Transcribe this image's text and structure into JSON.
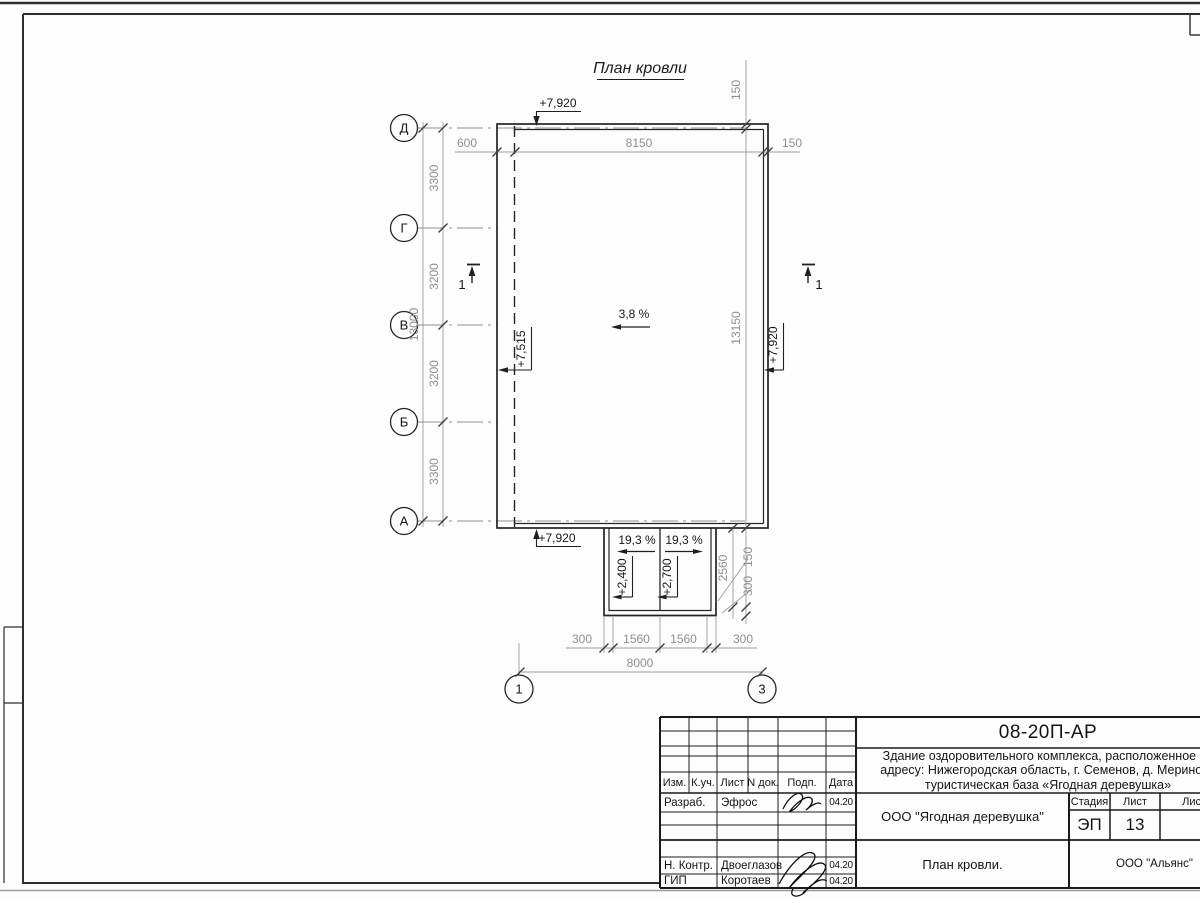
{
  "sheet": {
    "drawing_title": "План кровли"
  },
  "colors": {
    "line": "#242424",
    "dim_line": "#9c9c9c",
    "dim_text": "#8e8e8e",
    "text": "#161616"
  },
  "axes": {
    "left": [
      "Д",
      "Г",
      "В",
      "Б",
      "А"
    ],
    "bottom": [
      "1",
      "3"
    ]
  },
  "dims": {
    "top": [
      "600",
      "8150",
      "150"
    ],
    "left": [
      "3300",
      "3200",
      "3200",
      "3300"
    ],
    "left_total": "13000",
    "right_top": "150",
    "right_main": "13150",
    "right_150": "150",
    "right_300": "300",
    "right_2560": "2560",
    "bottom": [
      "300",
      "1560",
      "1560",
      "300"
    ],
    "bottom_total": "8000"
  },
  "marks": {
    "elev_top": "+7,920",
    "elev_bottom": "+7,920",
    "elev_left": "+7,515",
    "elev_right": "+7,920",
    "elev_canopy_left": "+2,400",
    "elev_canopy_right": "+2,700",
    "slope_main": "3,8 %",
    "slope_canopy_left": "19,3 %",
    "slope_canopy_right": "19,3 %",
    "section_left": "1",
    "section_right": "1"
  },
  "titleblock": {
    "code": "08-20П-АР",
    "description": [
      "Здание оздоровительного комплекса, расположенное по",
      "адресу: Нижегородская область, г. Семенов, д. Мериново",
      "туристическая база «Ягодная деревушка»"
    ],
    "columns": [
      "Изм.",
      "К.уч.",
      "Лист",
      "N док.",
      "Подп.",
      "Дата"
    ],
    "rows": [
      {
        "role": "Разраб.",
        "name": "Эфрос",
        "date": "04.20"
      },
      {
        "role": "Н. Контр.",
        "name": "Двоеглазов",
        "date": "04.20"
      },
      {
        "role": "ГИП",
        "name": "Коротаев",
        "date": "04.20"
      }
    ],
    "org": "ООО \"Ягодная деревушка\"",
    "stage_label": "Стадия",
    "stage_value": "ЭП",
    "sheet_label": "Лист",
    "sheet_value": "13",
    "sheets_label": "Листов",
    "doc_name": "План кровли.",
    "company": "ООО \"Альянс\""
  }
}
